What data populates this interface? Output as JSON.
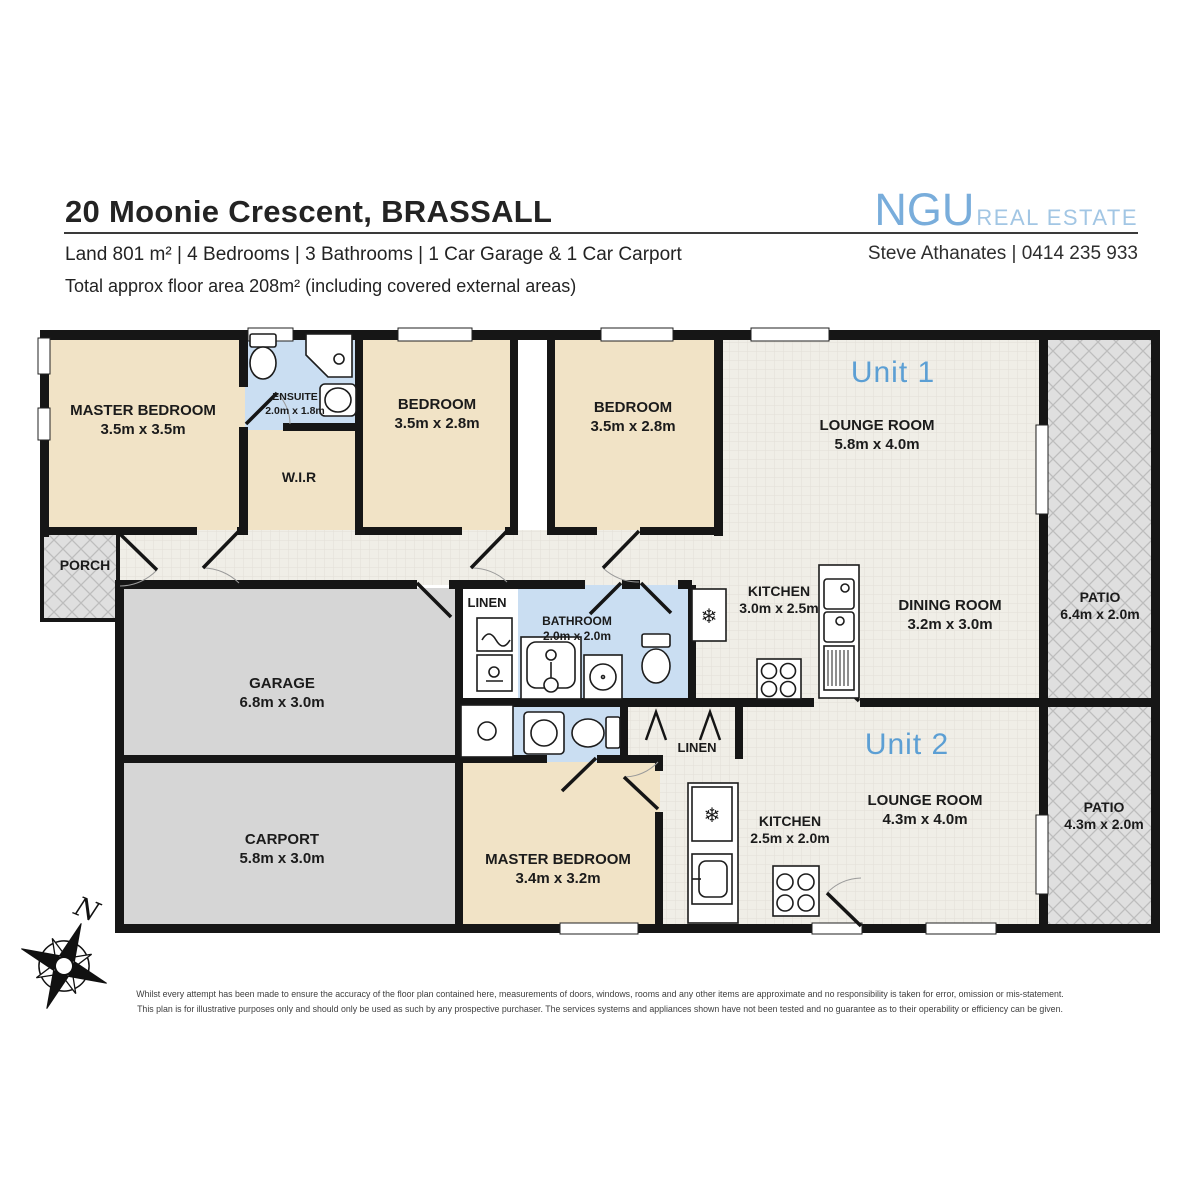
{
  "header": {
    "title": "20 Moonie Crescent, BRASSALL",
    "subtitle": "Land 801 m² | 4 Bedrooms | 3 Bathrooms | 1 Car Garage & 1 Car Carport",
    "floor_area": "Total approx floor area 208m² (including covered external areas)",
    "brand_name": "NGU",
    "brand_suffix": "REAL ESTATE",
    "agent": "Steve Athanates | 0414 235 933"
  },
  "colors": {
    "brand_blue": "#79ADDB",
    "brand_light_blue": "#A2C6E4",
    "unit_label_blue": "#5C9FD4",
    "bedroom_beige": "#F1E3C6",
    "bathroom_blue": "#CADEF2",
    "wall_black": "#161616",
    "garage_gray": "#D6D6D6",
    "patio_gray": "#DFDFDF"
  },
  "plan": {
    "unit1": "Unit 1",
    "unit2": "Unit 2",
    "fridge_icon": "❄",
    "rooms": {
      "master1": {
        "name": "MASTER BEDROOM",
        "dims": "3.5m x 3.5m"
      },
      "ensuite": {
        "name": "ENSUITE",
        "dims": "2.0m x 1.8m"
      },
      "wir": {
        "name": "W.I.R"
      },
      "bed2": {
        "name": "BEDROOM",
        "dims": "3.5m x 2.8m"
      },
      "bed3": {
        "name": "BEDROOM",
        "dims": "3.5m x 2.8m"
      },
      "lounge1": {
        "name": "LOUNGE ROOM",
        "dims": "5.8m x 4.0m"
      },
      "kitchen1": {
        "name": "KITCHEN",
        "dims": "3.0m x 2.5m"
      },
      "dining1": {
        "name": "DINING ROOM",
        "dims": "3.2m x 3.0m"
      },
      "patio1": {
        "name": "PATIO",
        "dims": "6.4m x 2.0m"
      },
      "porch": {
        "name": "PORCH"
      },
      "garage": {
        "name": "GARAGE",
        "dims": "6.8m x 3.0m"
      },
      "linen1": {
        "name": "LINEN"
      },
      "bathroom1": {
        "name": "BATHROOM",
        "dims": "2.0m x 2.0m"
      },
      "carport": {
        "name": "CARPORT",
        "dims": "5.8m x 3.0m"
      },
      "linen2": {
        "name": "LINEN"
      },
      "master2": {
        "name": "MASTER BEDROOM",
        "dims": "3.4m x 3.2m"
      },
      "kitchen2": {
        "name": "KITCHEN",
        "dims": "2.5m x 2.0m"
      },
      "lounge2": {
        "name": "LOUNGE ROOM",
        "dims": "4.3m x 4.0m"
      },
      "patio2": {
        "name": "PATIO",
        "dims": "4.3m x 2.0m"
      }
    }
  },
  "compass": {
    "label": "N"
  },
  "footer": {
    "line1": "Whilst every attempt has been made to ensure the accuracy of the floor plan contained here, measurements of doors, windows, rooms and any other items are approximate and no responsibility is taken for error, omission or mis-statement.",
    "line2": "This plan is for illustrative purposes only and should only be used as such by any prospective purchaser. The services systems and appliances shown have not been tested and no guarantee as to their operability or efficiency can be given."
  }
}
